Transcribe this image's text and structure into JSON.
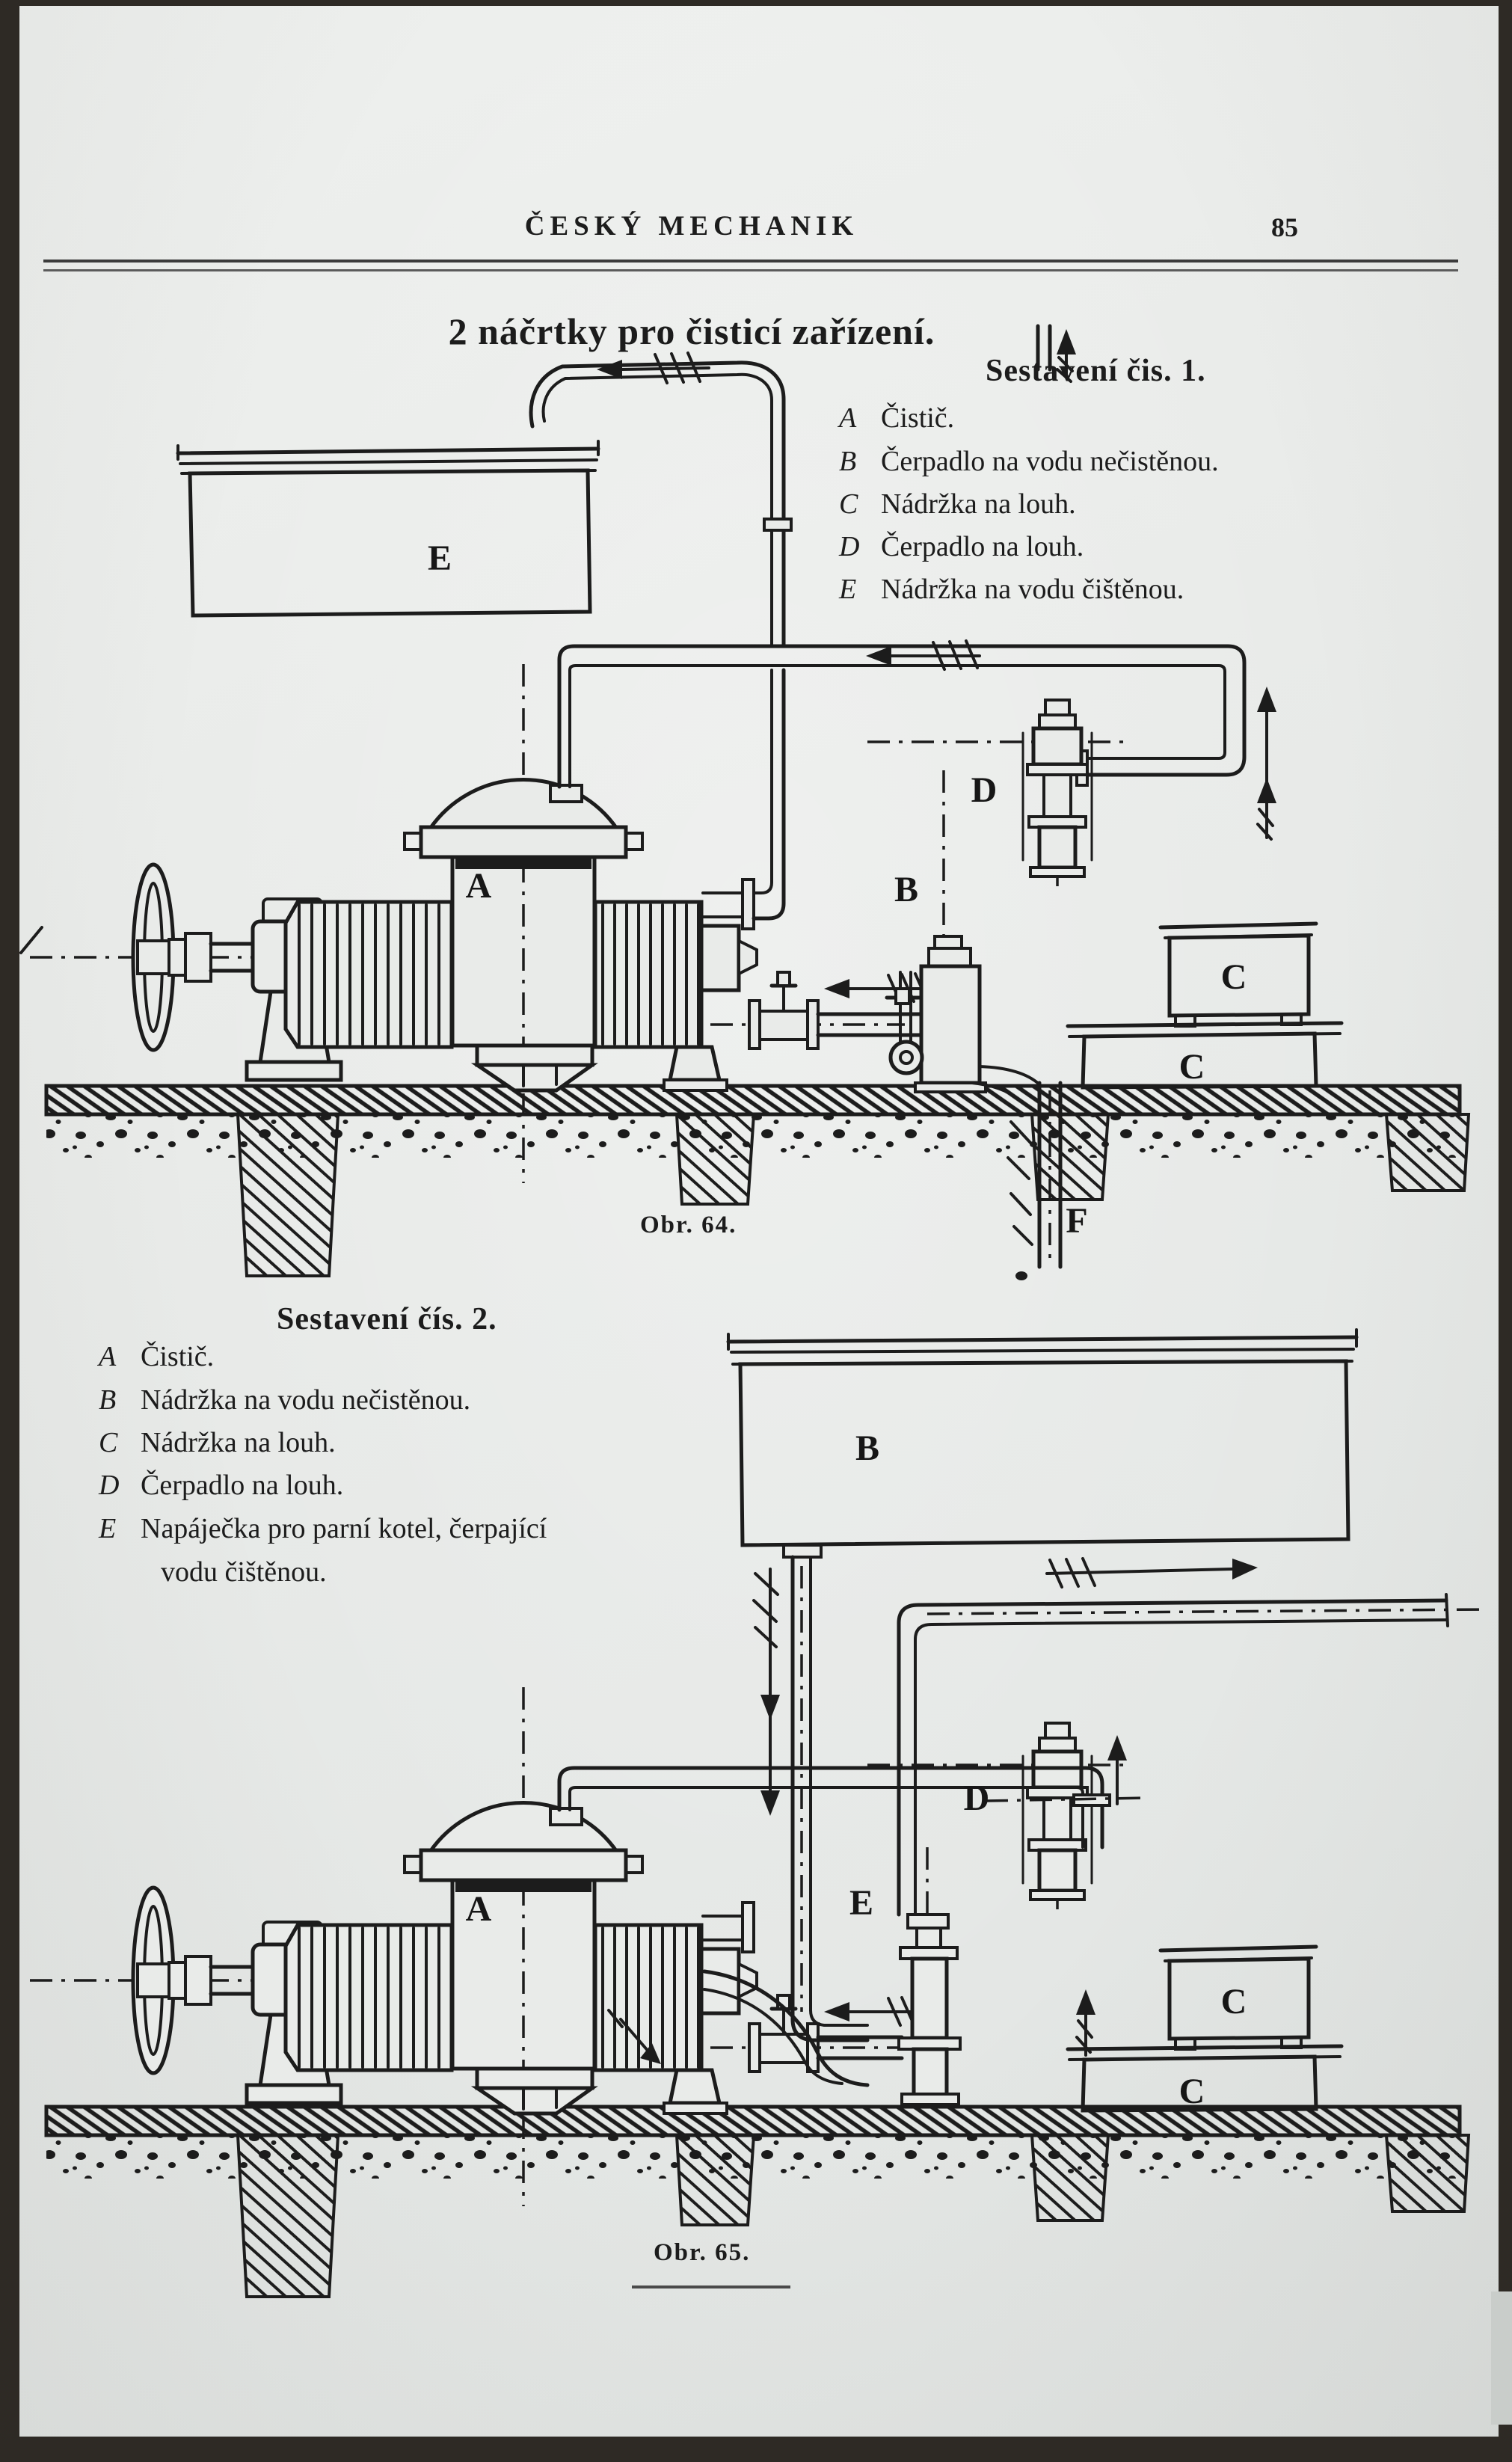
{
  "header": {
    "journal_title": "ČESKÝ MECHANIK",
    "page_number": "85"
  },
  "article": {
    "title": "2 náčrtky pro čisticí zařízení."
  },
  "figure1": {
    "heading": "Sestavení čis. 1.",
    "legend": [
      {
        "key": "A",
        "text": "Čistič."
      },
      {
        "key": "B",
        "text": "Čerpadlo na vodu nečistěnou."
      },
      {
        "key": "C",
        "text": "Nádržka na louh."
      },
      {
        "key": "D",
        "text": "Čerpadlo na louh."
      },
      {
        "key": "E",
        "text": "Nádržka na vodu čištěnou."
      }
    ],
    "caption": "Obr. 64.",
    "labels": {
      "tank_e": "E",
      "press_a": "A",
      "pump_b": "B",
      "pump_d": "D",
      "tank_c_upper": "C",
      "tank_c_lower": "C",
      "pipe_f": "F"
    }
  },
  "figure2": {
    "heading": "Sestavení čís. 2.",
    "legend": [
      {
        "key": "A",
        "text": "Čistič."
      },
      {
        "key": "B",
        "text": "Nádržka na vodu nečistěnou."
      },
      {
        "key": "C",
        "text": "Nádržka na louh."
      },
      {
        "key": "D",
        "text": "Čerpadlo na louh."
      },
      {
        "key": "E",
        "text": "Napáječka pro parní kotel, čerpající",
        "text2": "vodu čištěnou."
      }
    ],
    "caption": "Obr. 65.",
    "labels": {
      "tank_b": "B",
      "press_a": "A",
      "feeder_e": "E",
      "pump_d": "D",
      "tank_c_upper": "C",
      "tank_c_lower": "C"
    }
  },
  "colors": {
    "paper": "#e9ebe9",
    "ink": "#1c1c1c",
    "frame": "#2e2a25",
    "notch": "#c9cdca"
  }
}
